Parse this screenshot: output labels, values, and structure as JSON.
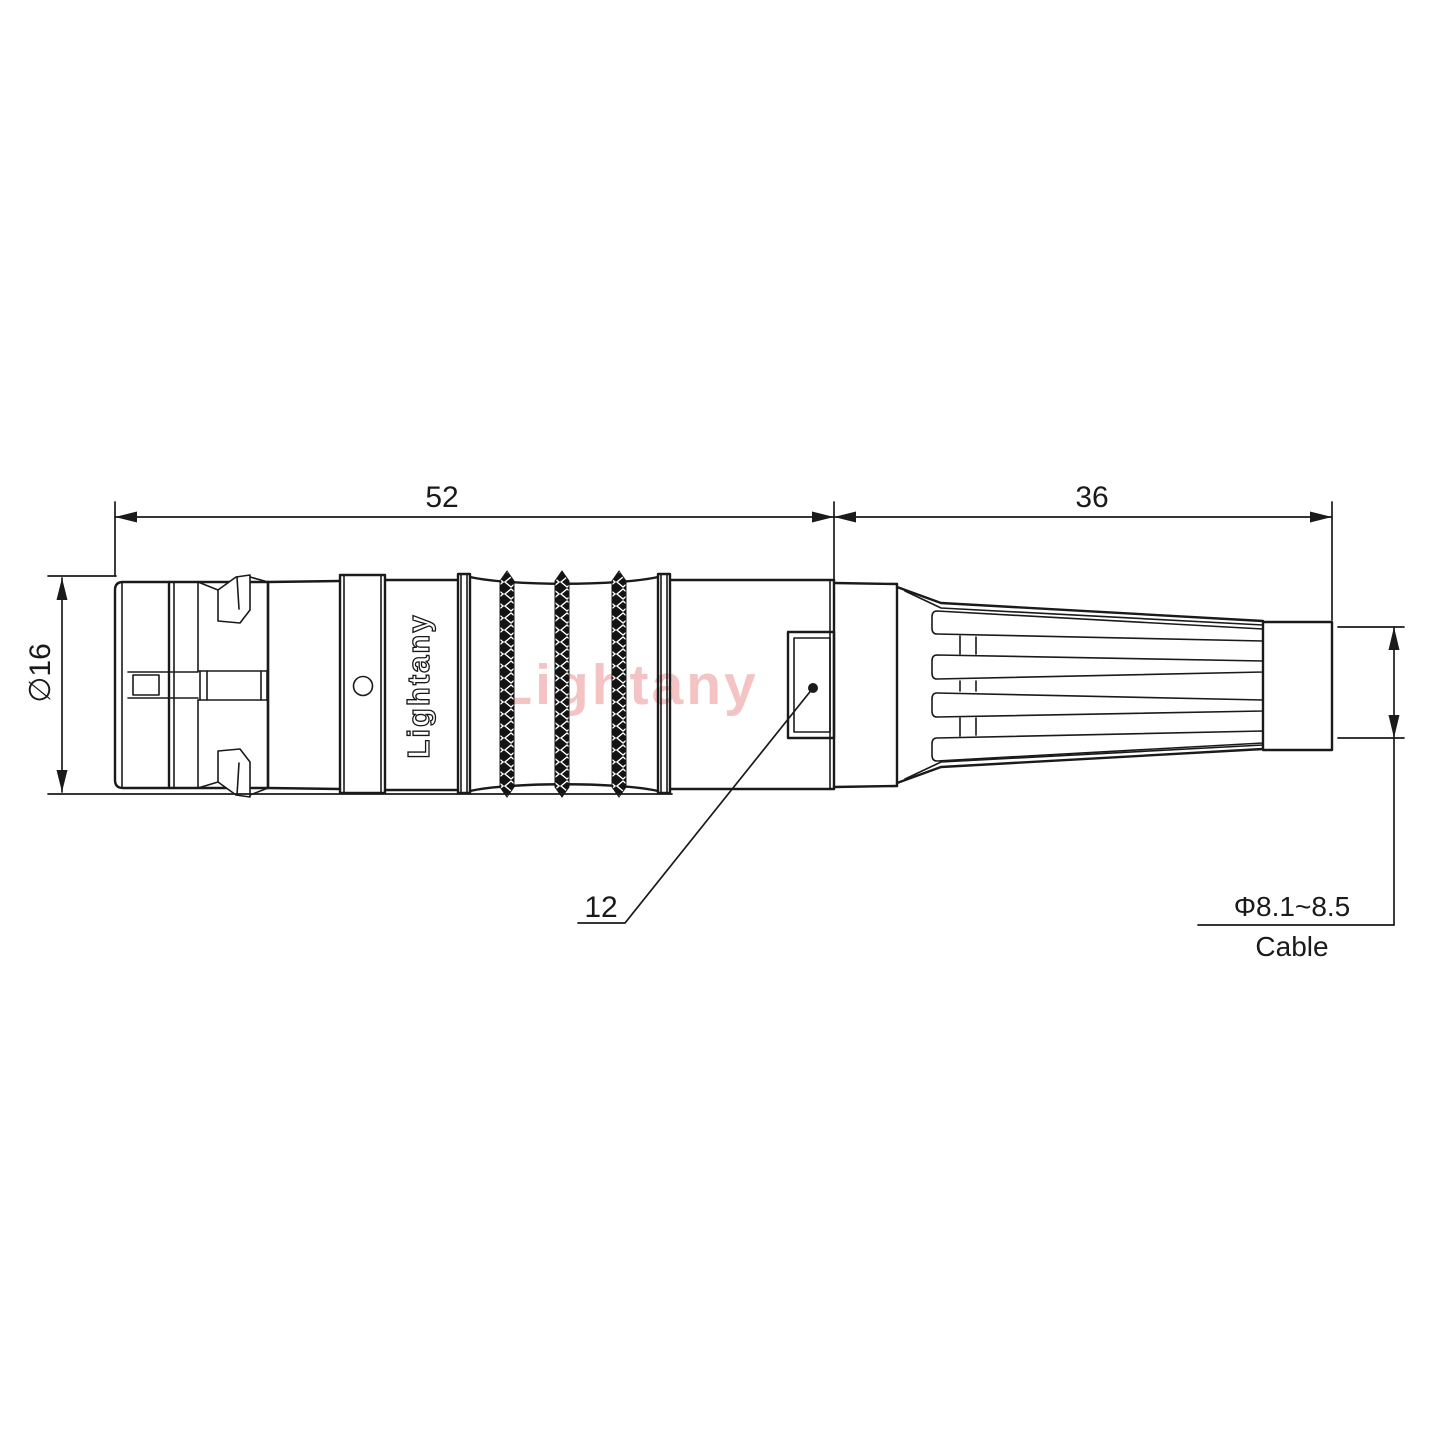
{
  "drawing": {
    "type": "technical-connector-drawing",
    "dimensions": {
      "body_length": "52",
      "boot_length": "36",
      "body_diameter": "∅16",
      "inner_size": "12",
      "cable_diameter": "Φ8.1~8.5",
      "cable_caption": "Cable"
    },
    "branding": {
      "engraving": "Lightany",
      "watermark": "Lightany"
    },
    "colors": {
      "line": "#1a1a1a",
      "watermark": "#f4c3c3",
      "background": "#ffffff"
    }
  }
}
